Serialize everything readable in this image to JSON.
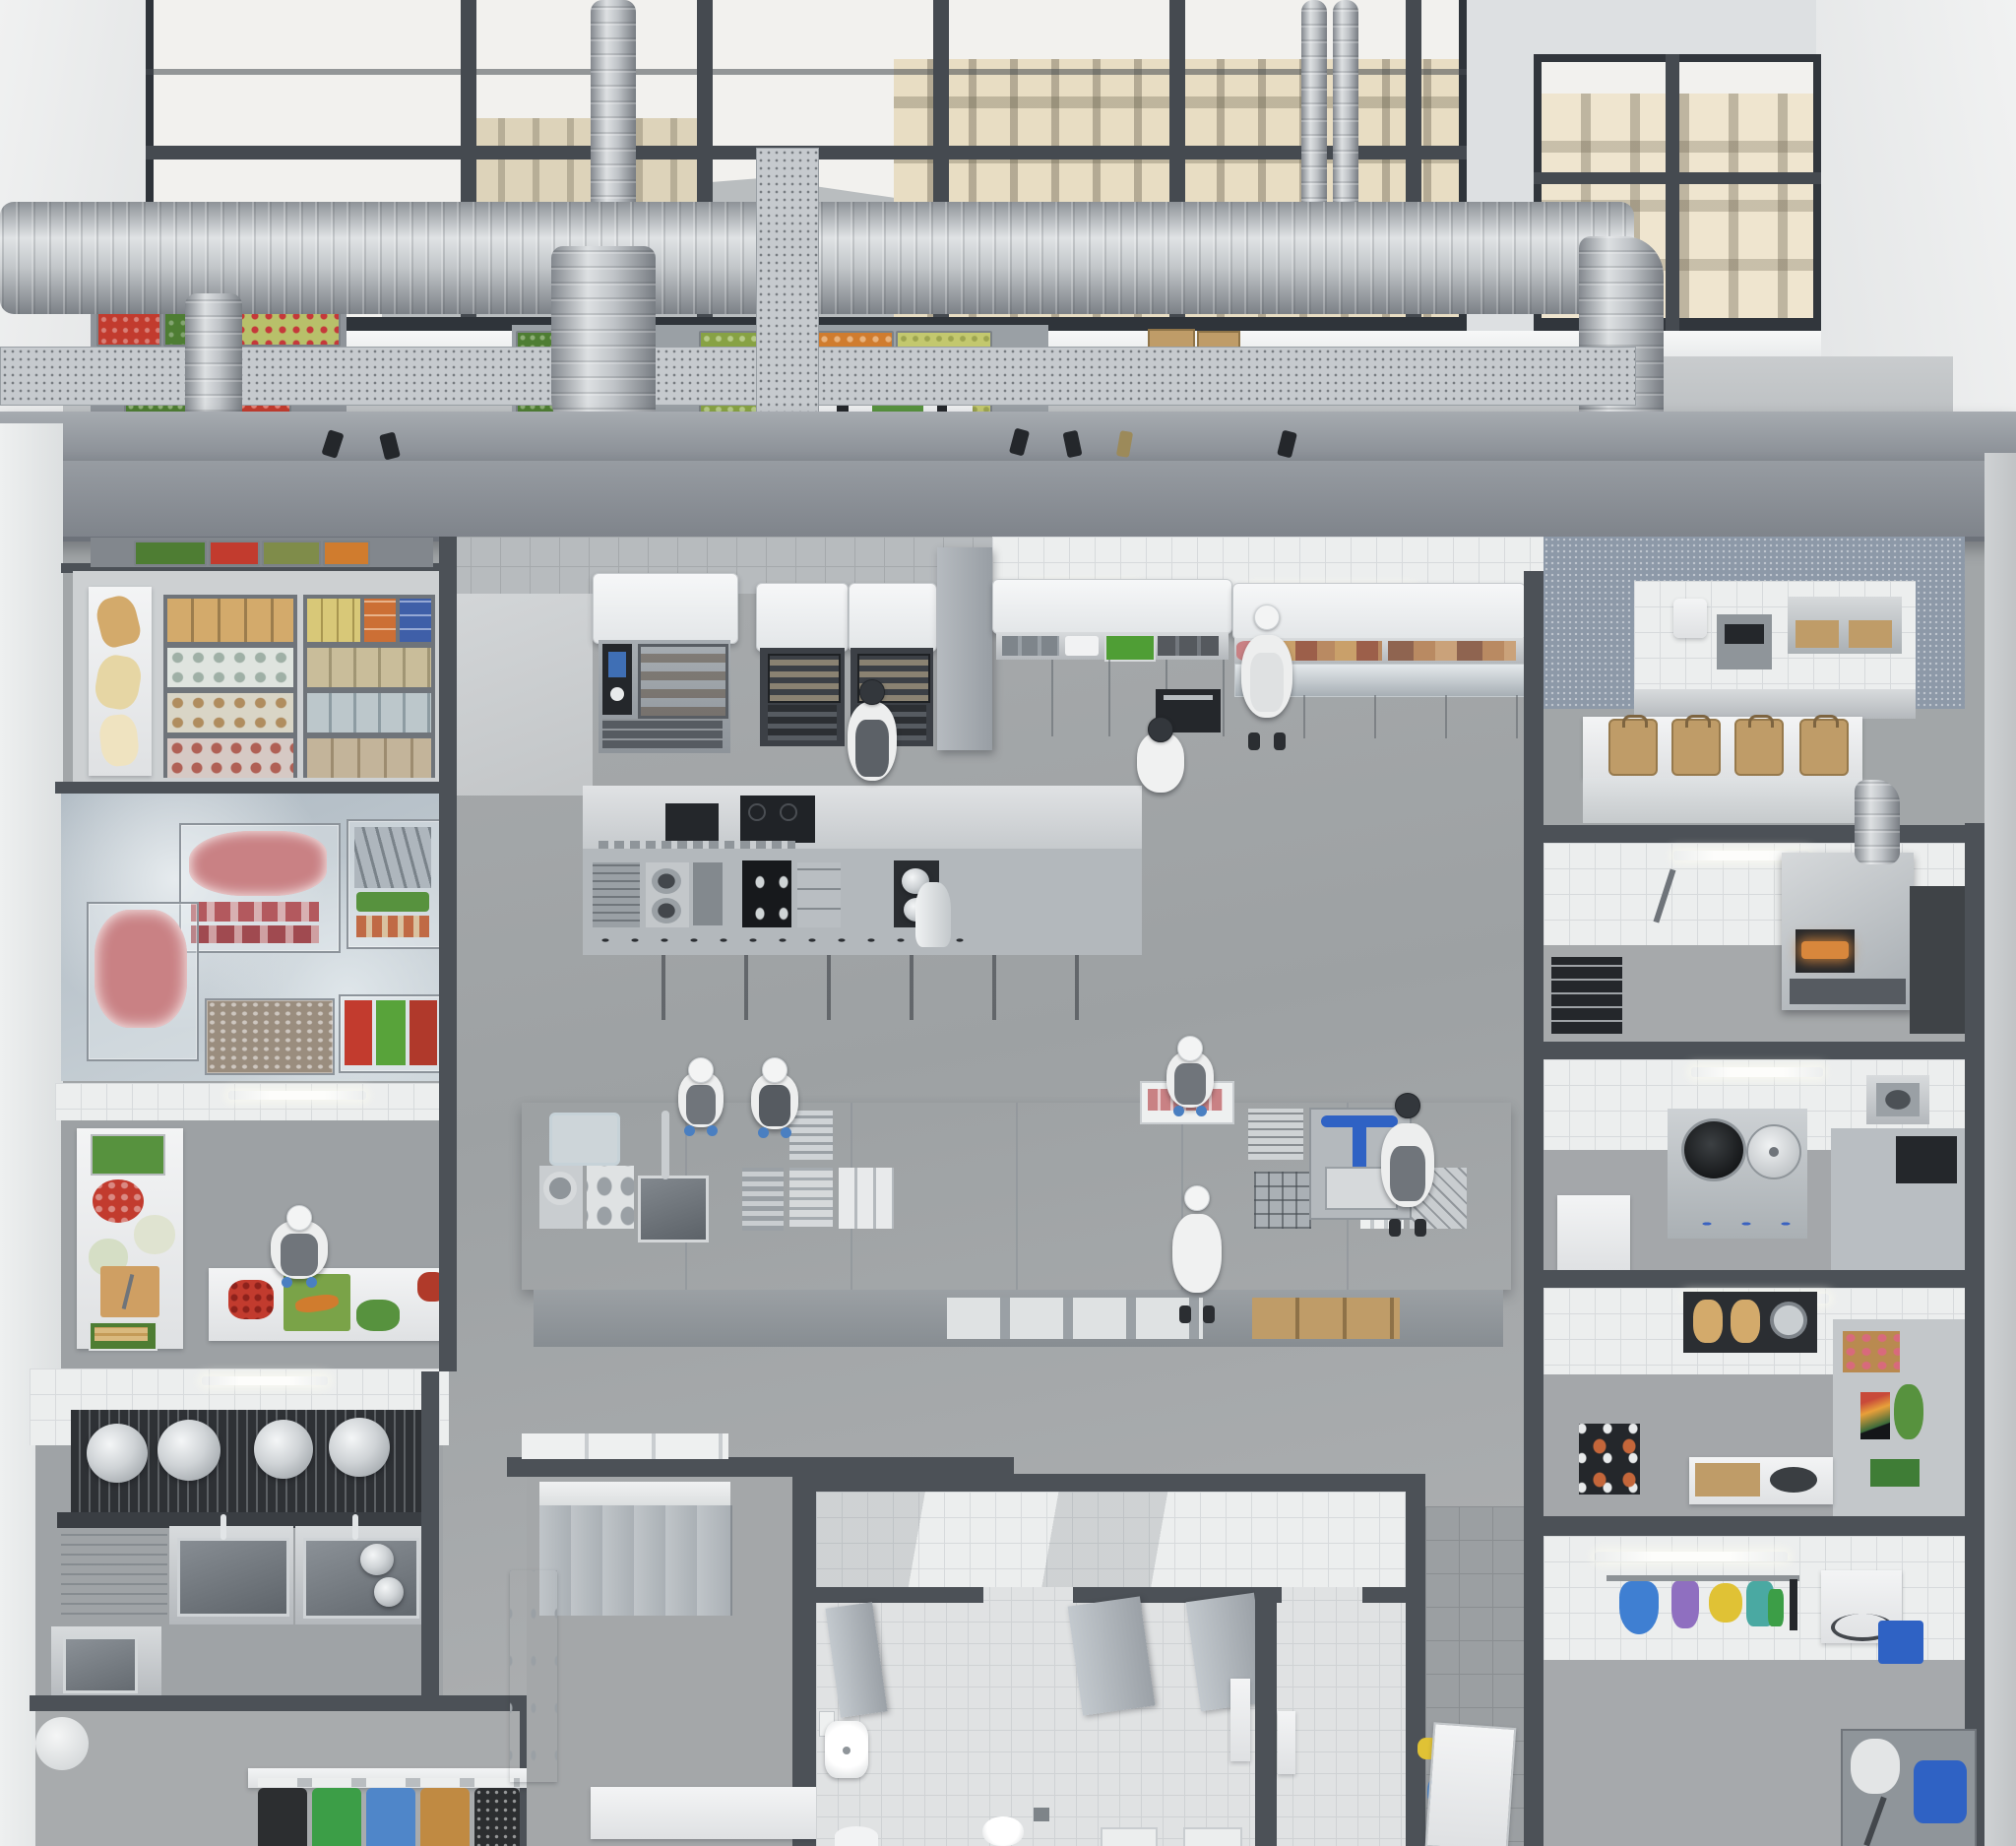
{
  "scene": {
    "type": "photorealistic 3d cutaway render",
    "subject": "overhead isometric view of a large commercial restaurant kitchen in an industrial loft",
    "features": "tall factory windows with city rooftops, exposed spiral ventilation ducts and perforated cable trays, concrete beams, cutaway room walls",
    "staff_count": 9
  },
  "palette": {
    "wall_cut": "#4c5157",
    "wall_white": "#eceeee",
    "beam": "#8e939a",
    "duct": "#c2c6ca",
    "floor_hall": "#a2a6a8",
    "floor_mezz_blue": "#8d99a8",
    "sky": "#f2f1ee",
    "building_beige": "#e8ddc3",
    "building_light": "#efe5cf",
    "roof_gray": "#b9bdbf",
    "stainless": "#c7cbcf",
    "black_equipment": "#202327",
    "oven_glow": "#c98a3e",
    "pizza_glow": "#d8873c",
    "display_blue": "#3f6fb5",
    "herb_green": "#4f9e35",
    "tomato_red": "#c23b2e",
    "carrot_orange": "#d07c2e",
    "cutting_board_tan": "#cf9f63",
    "cutting_board_green": "#7aa348",
    "kraft_bag": "#bf9c68",
    "bread_tan": "#d3aa6b",
    "meat_pink": "#c98184",
    "fish_silver": "#aeb6bd",
    "greens": "#57923e",
    "cucumber_green": "#4e7d33",
    "pack_orange": "#cc6f35",
    "pack_blue": "#3f5fa8",
    "chef_white": "#edeeee",
    "apron_gray": "#70757b",
    "glove_blue": "#4a7fc1",
    "cap_dark": "#33373c",
    "bin_black": "#2c2e30",
    "bin_green": "#3c9e47",
    "bin_blue": "#4f86c9",
    "bin_tan": "#c08a42",
    "clean_blue": "#3f7fd2",
    "clean_purple": "#8f6fc0",
    "clean_yellow": "#e0c235",
    "clean_teal": "#4aa9a2",
    "cart_blue": "#2f62c4"
  },
  "rooms": [
    {
      "id": "mezzanine-produce",
      "contents": "stacked crates of tomatoes, cucumbers, greens, berries; cardboard boxes; white prep table"
    },
    {
      "id": "dry-storage",
      "contents": "racks with flour bags, jars, canned goods, orange and blue packs, bread shelf"
    },
    {
      "id": "walk-in-freezer",
      "contents": "wire baskets of frozen meat, fish, shrimp, peppers and peas; frosted floor"
    },
    {
      "id": "vegetable-prep",
      "contents": "L-counter with tomatoes, cauliflower, greens, cutting board with knife; worker chopping carrots"
    },
    {
      "id": "pot-wash",
      "contents": "rack with four stock pots, double deep sinks, drainboard, corner sink"
    },
    {
      "id": "waste-sorting",
      "contents": "five recycling bins: black, green, blue, tan, black"
    },
    {
      "id": "combi-oven-line",
      "contents": "combi oven with blue control screen, two glowing baking ovens, tray stands, extraction funnels"
    },
    {
      "id": "hot-cooking-line",
      "contents": "island with griddle, french tops, open burners, black induction hobs, pan range, spice rail"
    },
    {
      "id": "central-prep-table",
      "contents": "long stainless table with sink, slicer, scale, tray racks, containers, under-shelf boxes"
    },
    {
      "id": "plating-counter",
      "contents": "wall counter with overshelf, herb bin, trays, inset oven"
    },
    {
      "id": "cold-prep-counter",
      "contents": "refrigerated counter with fish and deli containers, glass front"
    },
    {
      "id": "packing-takeaway",
      "contents": "tiled room with dispensers, toaster, napkin holders, four kraft takeaway bags on ledge"
    },
    {
      "id": "pizza-station",
      "contents": "deck pizza oven with glowing mouth and chimney, wall mixer tap, utensil rack"
    },
    {
      "id": "wok-station",
      "contents": "wok range with black wok, lid, blue knobs, corner sink, microwave"
    },
    {
      "id": "bakery-pastry-station",
      "contents": "bread slicer with loaves, pastry trays, menu screen, plant, counters"
    },
    {
      "id": "cleaning-room",
      "contents": "rail with blue, purple, yellow, teal cleaning gear, washer, blue crate, mop trolley with blue bucket"
    },
    {
      "id": "locker-room",
      "contents": "six gray staff lockers, white cabinets, bench"
    },
    {
      "id": "shower-wc",
      "contents": "white tiled stalls, partitions, sink, toilets, dispensers, floor drain"
    }
  ],
  "people": [
    {
      "role": "veg-prep worker",
      "station": "vegetable-prep",
      "attire": "white tee, white cap, gray apron, blue gloves",
      "activity": "chopping carrots on green board"
    },
    {
      "role": "chef",
      "station": "plating-counter",
      "attire": "white coat, dark cap",
      "activity": "working at wall counter"
    },
    {
      "role": "chef",
      "station": "cold-prep-counter",
      "attire": "white coat, white cap, white apron, dark trousers",
      "activity": "standing at refrigerated counter"
    },
    {
      "role": "chef",
      "station": "hot-cooking-line",
      "attire": "white coat, dark cap, dark apron",
      "activity": "cooking at island stove"
    },
    {
      "role": "prep cook",
      "station": "central-prep-table",
      "attire": "white tee, gray apron, blue gloves",
      "activity": "cutting on tan board"
    },
    {
      "role": "prep cook",
      "station": "central-prep-table",
      "attire": "white tee, dark apron, blue gloves",
      "activity": "working over steel bowl"
    },
    {
      "role": "prep cook",
      "station": "central-prep-table",
      "attire": "white tee, gray apron, blue gloves",
      "activity": "portioning fish into trays"
    },
    {
      "role": "prep cook",
      "station": "central-prep-table",
      "attire": "white top, gray apron, dark cap",
      "activity": "operating scale trolley with blue handles"
    },
    {
      "role": "chef",
      "station": "central-prep-table",
      "attire": "white coat, white cap",
      "activity": "standing south side of table"
    }
  ],
  "waste_bins": [
    {
      "color_key": "bin_black"
    },
    {
      "color_key": "bin_green"
    },
    {
      "color_key": "bin_blue"
    },
    {
      "color_key": "bin_tan"
    },
    {
      "color_key": "bin_black"
    }
  ],
  "takeaway_bags": 4,
  "stock_pots": 4,
  "lockers": 6
}
